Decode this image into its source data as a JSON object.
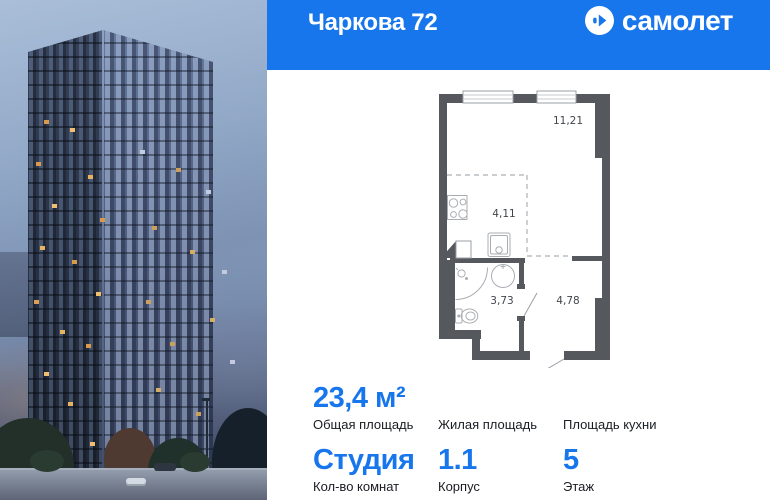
{
  "header": {
    "title": "Чаркова 72",
    "brand": "самолет"
  },
  "colors": {
    "brand_blue": "#1776EC",
    "plan_wall_grey": "#55585D"
  },
  "plan": {
    "areas": [
      {
        "room": "main-room",
        "value": "11,21"
      },
      {
        "room": "kitchen",
        "value": "4,11"
      },
      {
        "room": "bathroom",
        "value": "3,73"
      },
      {
        "room": "hallway",
        "value": "4,78"
      }
    ]
  },
  "stats": {
    "row1": [
      {
        "value": "23,4 м²",
        "label": "Общая площадь"
      },
      {
        "value": "",
        "label": "Жилая площадь"
      },
      {
        "value": "",
        "label": "Площадь кухни"
      }
    ],
    "row2": [
      {
        "value": "Студия",
        "label": "Кол-во комнат"
      },
      {
        "value": "1.1",
        "label": "Корпус"
      },
      {
        "value": "5",
        "label": "Этаж"
      }
    ]
  }
}
